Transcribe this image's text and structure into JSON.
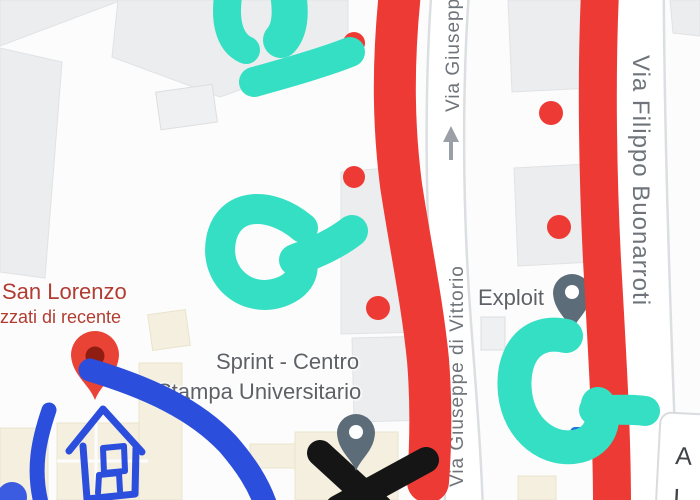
{
  "streets": {
    "top": "Via Giusepp",
    "center": "Via Giuseppe di Vittorio",
    "right": "Via Filippo Buonarroti"
  },
  "pois": {
    "san_lorenzo": {
      "title": "San Lorenzo",
      "subtitle": "izzati di recente"
    },
    "sprint": {
      "line1": "Sprint - Centro",
      "line2": "Stampa Universitario"
    },
    "exploit": {
      "label": "Exploit"
    }
  },
  "partial_card": {
    "line1": "A",
    "line2": "L"
  },
  "annotation_colors": {
    "red": "#ee3a34",
    "teal": "#35dfc3",
    "blue": "#2b4edc",
    "black": "#151515"
  },
  "map_colors": {
    "poi_label_gray": "#5e6267",
    "poi_label_red": "#b13c31",
    "street_label_gray": "#6f747a",
    "pin_red": "#e94335",
    "pin_gray": "#5d6c79"
  }
}
